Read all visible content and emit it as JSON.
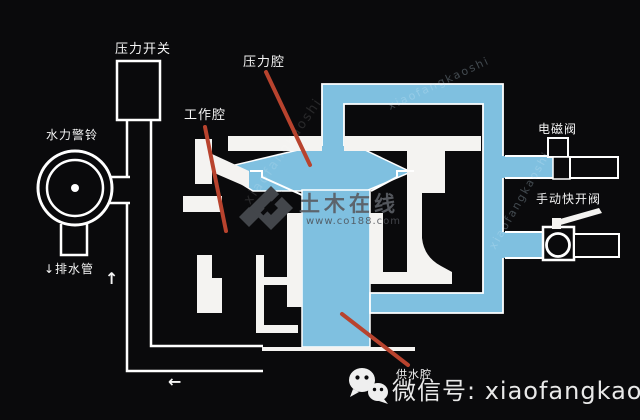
{
  "diagram": {
    "type": "fire-protection deluge/alarm valve cross-section",
    "labels": {
      "pressure_switch": "压力开关",
      "hydraulic_alarm_bell": "水力警铃",
      "drain_pipe": "↓排水管",
      "working_chamber": "工作腔",
      "pressure_chamber": "压力腔",
      "solenoid_valve": "电磁阀",
      "manual_quick_open_valve": "手动快开阀",
      "supply_chamber": "供水腔",
      "flow_arrow_up": "↑",
      "flow_arrow_left": "←"
    },
    "colors": {
      "background": "#0a0a0c",
      "water_blue": "#7fc0e0",
      "casting_white": "#f4f3f1",
      "outline_white": "#ffffff",
      "leader_red": "#b8432e",
      "watermark_gray": "#43464b"
    }
  },
  "watermark": {
    "logo_text": "土木在线",
    "site_text": "www.co188.com",
    "diagonal_text": "xiaofangkaoshi"
  },
  "footer": {
    "wechat_label": "微信号:",
    "wechat_id": " xiaofangkaoshi"
  }
}
